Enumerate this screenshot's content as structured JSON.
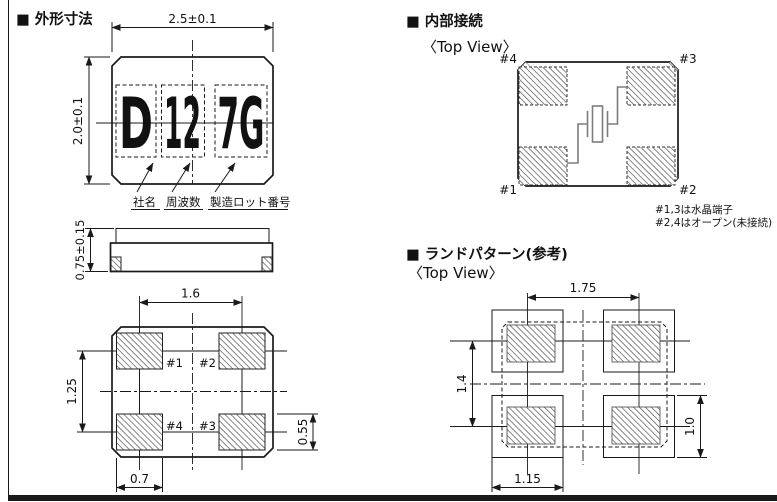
{
  "sections": {
    "outline": {
      "title": "■ 外形寸法",
      "marking": {
        "company": "D",
        "frequency": "12",
        "lot": "7G"
      },
      "labels": {
        "company": "社名",
        "frequency": "周波数",
        "lot": "製造ロット番号"
      },
      "dims": {
        "width": "2.5±0.1",
        "height": "2.0±0.1",
        "thickness": "0.75±0.15",
        "pad_pitch_x": "1.6",
        "pad_pitch_y": "1.25",
        "pad_width": "0.7",
        "pad_height": "0.55"
      },
      "pads": {
        "p1": "#1",
        "p2": "#2",
        "p3": "#3",
        "p4": "#4"
      }
    },
    "internal": {
      "title": "■ 内部接続",
      "view": "〈Top View〉",
      "pads": {
        "p1": "#1",
        "p2": "#2",
        "p3": "#3",
        "p4": "#4"
      },
      "notes": [
        "#1,3は水晶端子",
        "#2,4はオープン(未接続)"
      ]
    },
    "land": {
      "title": "■ ランドパターン(参考)",
      "view": "〈Top View〉",
      "dims": {
        "pitch_x": "1.75",
        "pitch_y": "1.4",
        "land_width": "1.15",
        "land_height": "1.0"
      }
    }
  },
  "colors": {
    "line": "#1a1a1a",
    "hatch": "#555555",
    "lead": "#7d7d7d",
    "background": "#ffffff"
  }
}
